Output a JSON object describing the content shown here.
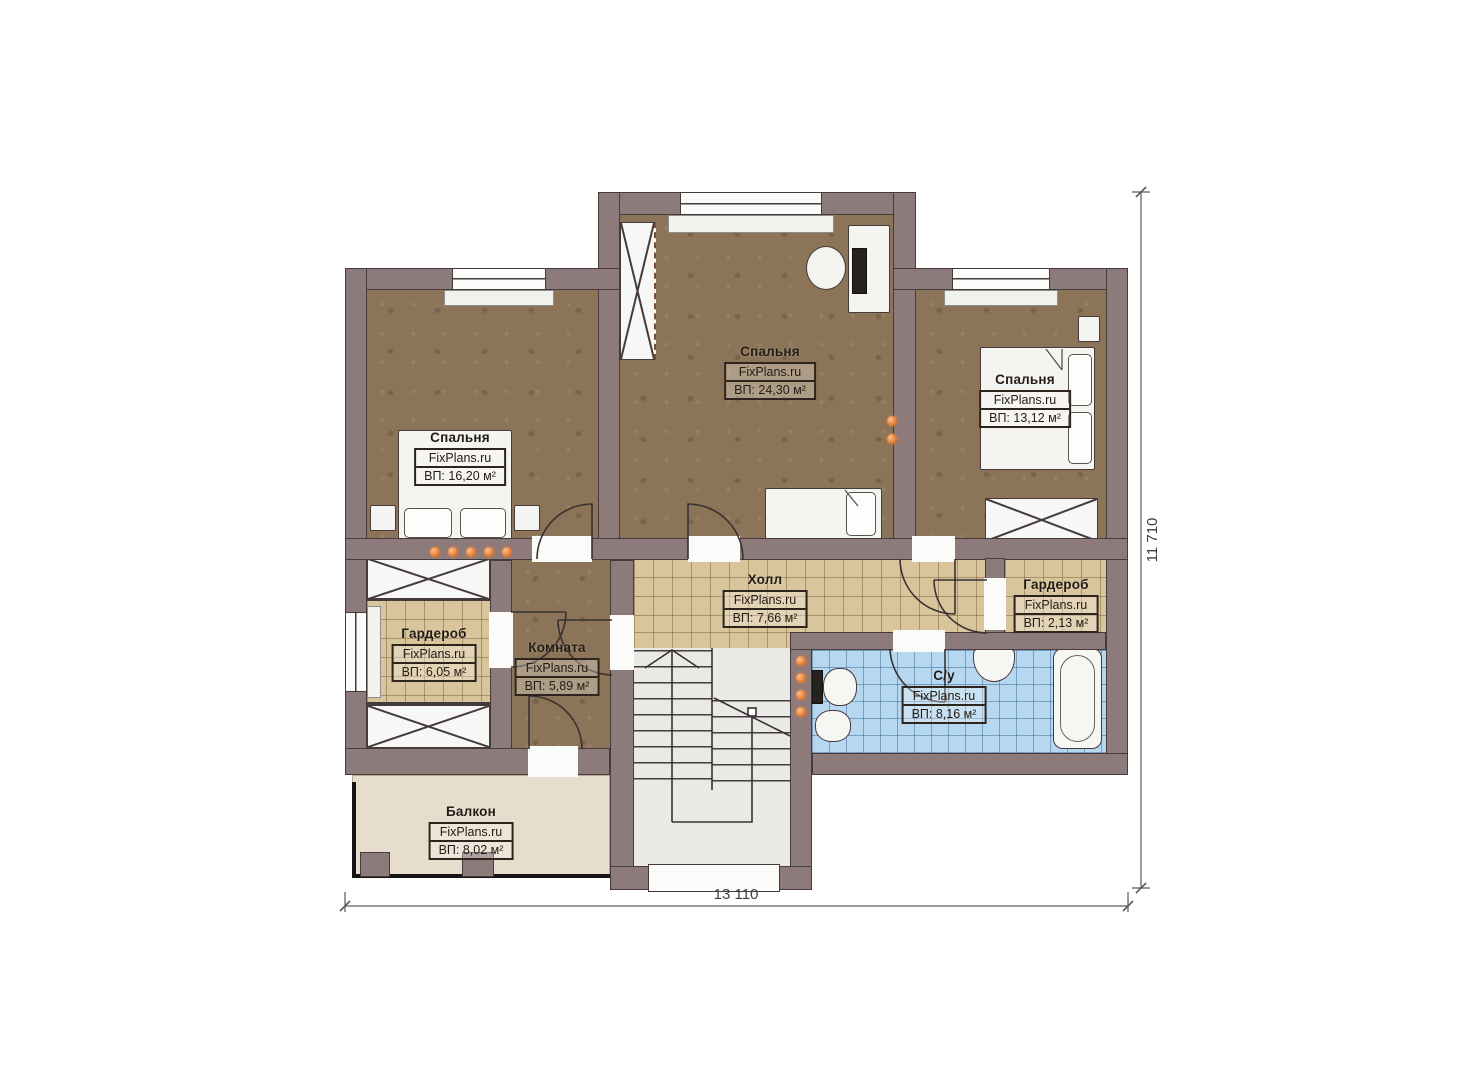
{
  "rooms": {
    "bedroom_top": {
      "name": "Спальня",
      "brand": "FixPlans.ru",
      "area": "ВП: 24,30 м²"
    },
    "bedroom_right": {
      "name": "Спальня",
      "brand": "FixPlans.ru",
      "area": "ВП: 13,12 м²"
    },
    "bedroom_left": {
      "name": "Спальня",
      "brand": "FixPlans.ru",
      "area": "ВП: 16,20 м²"
    },
    "hall": {
      "name": "Холл",
      "brand": "FixPlans.ru",
      "area": "ВП: 7,66 м²"
    },
    "wardrobe_right": {
      "name": "Гардероб",
      "brand": "FixPlans.ru",
      "area": "ВП: 2,13 м²"
    },
    "wardrobe_left": {
      "name": "Гардероб",
      "brand": "FixPlans.ru",
      "area": "ВП: 6,05 м²"
    },
    "room": {
      "name": "Комната",
      "brand": "FixPlans.ru",
      "area": "ВП: 5,89 м²"
    },
    "bathroom": {
      "name": "С/у",
      "brand": "FixPlans.ru",
      "area": "ВП: 8,16 м²"
    },
    "balcony": {
      "name": "Балкон",
      "brand": "FixPlans.ru",
      "area": "ВП: 8,02 м²"
    }
  },
  "dimensions": {
    "width_label": "13 110",
    "height_label": "11 710"
  },
  "colors": {
    "wall": "#8d7a7b",
    "wallLine": "#453a3c",
    "floorBedroom": "#8b7457",
    "floorTile": "#d9c59c",
    "floorBath": "#b5d7f0",
    "floorStair": "#e9e9e6",
    "floorBalcony": "#e6ddcd",
    "furniture": "#f4f4f1",
    "radiator": "#e8823a"
  }
}
